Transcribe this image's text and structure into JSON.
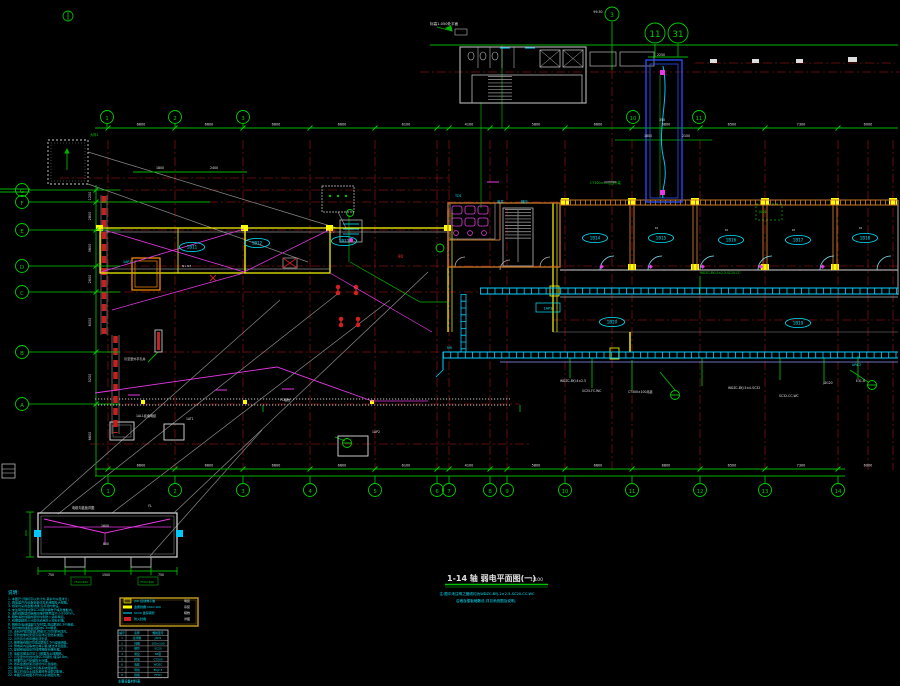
{
  "title": {
    "main": "1-14 轴 弱电平面图(一)",
    "scale": "1:100",
    "sub1": "注:图中未注明之管线均为WDZC-BYJ-2×2.5-SC20-CC.WC",
    "sub2": "沿墙及楼板暗敷设,详见系统图及说明。"
  },
  "colors": {
    "green": "#00c000",
    "cyan": "#00e5ff",
    "white": "#e0e0e0",
    "red": "#ff3030",
    "magenta": "#ff60ff",
    "yellow": "#ffd000",
    "maroon": "#7d0f0f",
    "blue": "#2850ff"
  },
  "grid": {
    "bottom": [
      {
        "label": "1",
        "x": 108
      },
      {
        "label": "2",
        "x": 175
      },
      {
        "label": "3",
        "x": 243
      },
      {
        "label": "4",
        "x": 310
      },
      {
        "label": "5",
        "x": 375
      },
      {
        "label": "6",
        "x": 437
      },
      {
        "label": "7",
        "x": 449
      },
      {
        "label": "8",
        "x": 490
      },
      {
        "label": "9",
        "x": 507
      },
      {
        "label": "10",
        "x": 565
      },
      {
        "label": "11",
        "x": 632
      },
      {
        "label": "12",
        "x": 700
      },
      {
        "label": "13",
        "x": 765
      },
      {
        "label": "14",
        "x": 838
      }
    ],
    "top": [
      {
        "label": "1",
        "x": 107
      },
      {
        "label": "2",
        "x": 175
      },
      {
        "label": "3",
        "x": 243
      }
    ],
    "left": [
      {
        "label": "G",
        "y": 190
      },
      {
        "label": "F",
        "y": 202
      },
      {
        "label": "E",
        "y": 230
      },
      {
        "label": "D",
        "y": 266
      },
      {
        "label": "C",
        "y": 292
      },
      {
        "label": "B",
        "y": 352
      },
      {
        "label": "A",
        "y": 404
      }
    ],
    "extra": [
      {
        "label": "3",
        "x": 612,
        "y": 14,
        "r": 7
      },
      {
        "label": "11",
        "x": 655,
        "y": 33,
        "r": 10
      },
      {
        "label": "31",
        "x": 678,
        "y": 33,
        "r": 10
      },
      {
        "label": "10",
        "x": 633,
        "y": 117,
        "r": 6.5
      },
      {
        "label": "11",
        "x": 699,
        "y": 117,
        "r": 6.5
      }
    ]
  },
  "dims": {
    "top": [
      [
        141,
        "6600"
      ],
      [
        209,
        "6600"
      ],
      [
        276,
        "6600"
      ],
      [
        342,
        "6600"
      ],
      [
        406,
        "6100"
      ],
      [
        469,
        "4100"
      ],
      [
        536,
        "5800"
      ],
      [
        598,
        "6600"
      ],
      [
        666,
        "6800"
      ],
      [
        732,
        "6500"
      ],
      [
        801,
        "7300"
      ],
      [
        868,
        "6000"
      ]
    ],
    "bottom": [
      [
        141,
        "6600"
      ],
      [
        209,
        "6600"
      ],
      [
        276,
        "6600"
      ],
      [
        342,
        "6600"
      ],
      [
        406,
        "6100"
      ],
      [
        469,
        "4100"
      ],
      [
        536,
        "5800"
      ],
      [
        598,
        "6600"
      ],
      [
        666,
        "6800"
      ],
      [
        732,
        "6500"
      ],
      [
        801,
        "7300"
      ],
      [
        868,
        "6000"
      ]
    ],
    "left": [
      [
        196,
        "1200"
      ],
      [
        216,
        "2800"
      ],
      [
        248,
        "3600"
      ],
      [
        279,
        "2600"
      ],
      [
        322,
        "6000"
      ],
      [
        378,
        "5200"
      ],
      [
        436,
        "6600"
      ]
    ],
    "misc": [
      [
        661,
        56,
        "2250"
      ],
      [
        598,
        13,
        "99.50"
      ],
      [
        648,
        137,
        "1800"
      ],
      [
        686,
        137,
        "2100"
      ],
      [
        662,
        121,
        "350"
      ],
      [
        160,
        169,
        "1800"
      ],
      [
        214,
        169,
        "2400"
      ],
      [
        105,
        527,
        "1600"
      ],
      [
        106,
        545,
        "800"
      ],
      [
        51,
        576,
        "750"
      ],
      [
        106,
        576,
        "1500"
      ],
      [
        161,
        576,
        "750"
      ],
      [
        150,
        507,
        "FL"
      ]
    ]
  },
  "rooms": [
    {
      "x": 192,
      "y": 247,
      "t": "1B11"
    },
    {
      "x": 257,
      "y": 243,
      "t": "1B12"
    },
    {
      "x": 344,
      "y": 241,
      "t": "1B13"
    },
    {
      "x": 595,
      "y": 238,
      "t": "1B14"
    },
    {
      "x": 661,
      "y": 238,
      "t": "1B15"
    },
    {
      "x": 731,
      "y": 240,
      "t": "1B16"
    },
    {
      "x": 798,
      "y": 240,
      "t": "1B17"
    },
    {
      "x": 865,
      "y": 238,
      "t": "1B18"
    },
    {
      "x": 798,
      "y": 323,
      "t": "1B19"
    },
    {
      "x": 612,
      "y": 322,
      "t": "1B20"
    }
  ],
  "box_labels": [
    {
      "x": 548,
      "y": 308,
      "t": "1AP3"
    }
  ],
  "ann": [
    [
      430,
      25,
      "标高1.050处平面",
      "w",
      3.6
    ],
    [
      497,
      203,
      "电井",
      "c",
      3.4
    ],
    [
      521,
      203,
      "梯厅",
      "c",
      3.4
    ],
    [
      455,
      197,
      "TD1",
      "c",
      3.4
    ],
    [
      590,
      184,
      "CT100×50沿顶吊装",
      "g",
      3.3
    ],
    [
      759,
      213,
      "JXD1",
      "g",
      3.2
    ],
    [
      700,
      274,
      "WDZC-BYJ-3×2.5-SC20-CC",
      "g",
      3.1
    ],
    [
      560,
      382,
      "WDZC-BYJ-4×2.5",
      "w",
      3.1
    ],
    [
      582,
      392,
      "SC25-FC.WC",
      "w",
      3.1
    ],
    [
      628,
      393,
      "CT300×100吊装",
      "w",
      3.1
    ],
    [
      728,
      389,
      "WDZC-BYJ-5×4-SC32",
      "w",
      3.1
    ],
    [
      779,
      397,
      "SC32-CC.WC",
      "w",
      3.1
    ],
    [
      823,
      384,
      "JDG20",
      "w",
      3.1
    ],
    [
      856,
      382,
      "E31-6",
      "w",
      3.1
    ],
    [
      852,
      366,
      "AP4-2",
      "c",
      3.1
    ],
    [
      280,
      401,
      "FC暗敷",
      "w",
      3.1
    ],
    [
      124,
      360,
      "引至室外手孔井",
      "w",
      3.1
    ],
    [
      136,
      417,
      "1AL1挂墙明装",
      "w",
      3.1
    ],
    [
      186,
      420,
      "1AT1",
      "w",
      3.1
    ],
    [
      372,
      433,
      "1AP2",
      "w",
      3.1
    ],
    [
      123,
      263,
      "1AP1",
      "c",
      3.3
    ],
    [
      182,
      267,
      "N1·N3",
      "w",
      3
    ],
    [
      330,
      233,
      "90",
      "r",
      4
    ],
    [
      398,
      258,
      "90",
      "r",
      4
    ],
    [
      90,
      136,
      "大样1",
      "g",
      3.3
    ],
    [
      447,
      349,
      "MR",
      "c",
      3.2
    ],
    [
      655,
      229,
      "td",
      "w",
      3
    ],
    [
      725,
      231,
      "td",
      "w",
      3
    ],
    [
      792,
      231,
      "td",
      "w",
      3
    ],
    [
      859,
      229,
      "td",
      "w",
      3
    ],
    [
      72,
      509,
      "电缆沟盖板详图",
      "w",
      3.2
    ],
    [
      74,
      583,
      "750×300",
      "g",
      3
    ],
    [
      140,
      583,
      "750×300",
      "g",
      3
    ],
    [
      27,
      536,
      "900",
      "g",
      3,
      -90
    ]
  ],
  "notes": {
    "header": "说明:",
    "lines": [
      "1. 本图尺寸除标高以米计外,其余均以毫米计。",
      "2. 弱电竖井内设备安装详见系统图及大样图。",
      "3. 桥架均采用金属线槽,沿吊顶内敷设。",
      "4. 未注明管线均穿SC20钢管暗敷于墙及楼板内。",
      "5. 消防线路穿管暗敷时保护层厚度不小于30mm。",
      "6. 明敷消防线路的钢管均刷防火涂料两道。",
      "7. 线槽穿越防火分区处采用防火材料封堵。",
      "8. 网络及电话插座均为86型,底边距地0.3m暗装。",
      "9. 有线电视插座底边距地0.3m暗装。",
      "10. 无线AP吸顶安装,预留SC20管至吊顶内。",
      "11. 安防摄像机安装高度详见安防系统图。",
      "12. 背景音乐扬声器吸顶安装。",
      "13. 楼层接线箱JXD底边距地1.5m挂墙明装。",
      "14. 弱电间内设等电位端子箱,做法详见图集。",
      "15. 穿越伸缩缝处管线两端做补偿处理。",
      "16. 电缆沟做法详见1-1剖面及土建图纸。",
      "17. 引至室外管线均穿SC50钢管,埋深0.8m。",
      "18. 预埋管出户处做防水处理。",
      "19. 所有金属桥架及钢管均可靠接地。",
      "20. 图例未尽事宜详见各系统图说明。",
      "21. 施工时请与土建及其他专业密切配合。",
      "22. 本图与系统图不符处以系统图为准。"
    ]
  },
  "legend": {
    "rows": [
      {
        "sym": "box-yellow",
        "label": "JXD 接线端子箱",
        "note": "明装"
      },
      {
        "sym": "bar-yellow",
        "label": "金属线槽 100×100",
        "note": "吊装"
      },
      {
        "sym": "line-cyan",
        "label": "SC20 镀锌钢管",
        "note": "暗敷"
      },
      {
        "sym": "box-red",
        "label": "防火封堵",
        "note": "详图"
      }
    ]
  },
  "table": {
    "headers": [
      "编号",
      "名称",
      "规格型号"
    ],
    "rows": [
      [
        "1",
        "接线箱",
        "JXD1"
      ],
      [
        "2",
        "线槽",
        "100×100"
      ],
      [
        "3",
        "钢管",
        "SC20"
      ],
      [
        "4",
        "暗盒",
        "86型"
      ],
      [
        "5",
        "桥架",
        "CT200"
      ],
      [
        "6",
        "电缆",
        "WDZC"
      ],
      [
        "7",
        "导线",
        "BYJ2.5"
      ],
      [
        "8",
        "终端",
        "FTTH"
      ]
    ],
    "caption": "主要设备材料表"
  }
}
